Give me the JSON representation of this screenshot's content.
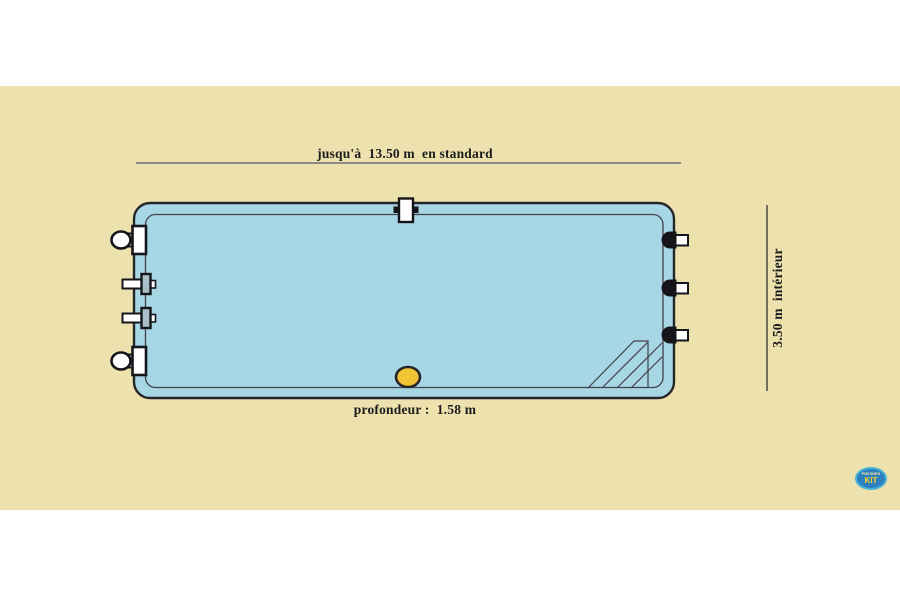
{
  "diagram": {
    "top_dimension_label": "jusqu'à  13.50 m  en standard",
    "side_dimension_label": "3.50 m  intérieur",
    "depth_label": "profondeur :  1.58 m"
  },
  "logo": {
    "line1": "PISCINES",
    "line2": "KIT"
  },
  "colors": {
    "canvas_beige": "#EDE2AE",
    "pool_blue": "#A7D6E5",
    "drain_yellow": "#F2C435",
    "outline_dark": "#26262A",
    "inner_line": "#41414B",
    "dim_line_gray": "#8C8C84",
    "logo_blue": "#2E7FC0"
  }
}
